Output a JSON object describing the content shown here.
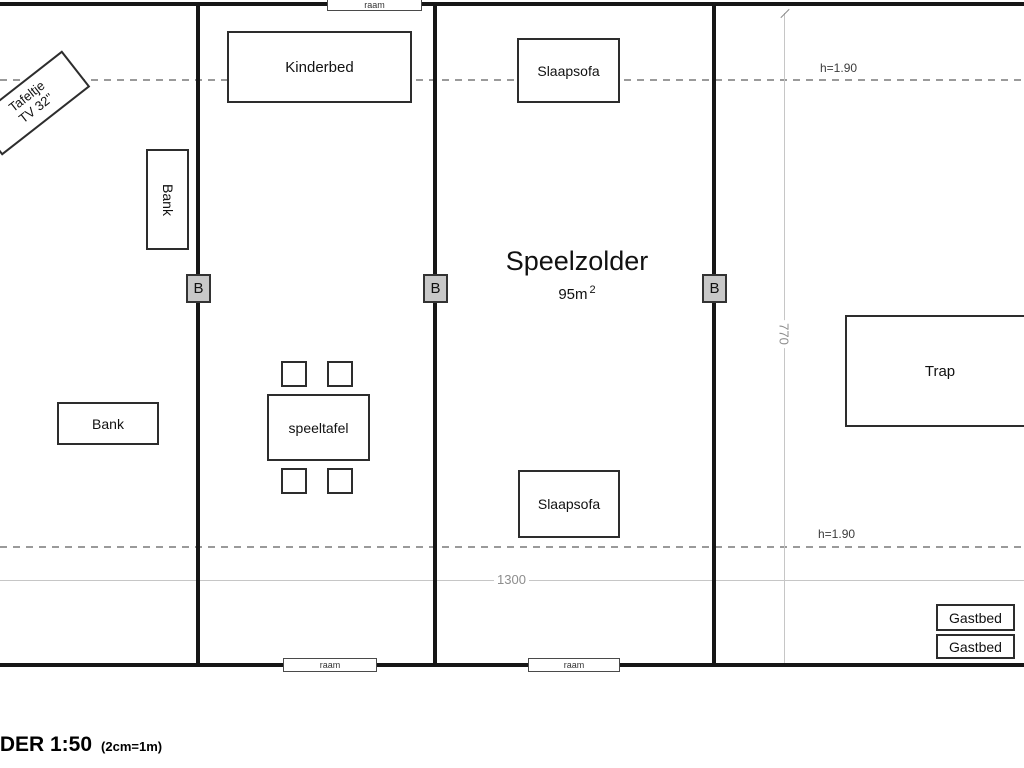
{
  "room": {
    "name": "Speelzolder",
    "area_value": "95m",
    "area_exponent": "2"
  },
  "furniture": {
    "kinderbed": "Kinderbed",
    "slaapsofa_top": "Slaapsofa",
    "slaapsofa_bottom": "Slaapsofa",
    "bank_left_vertical": "Bank",
    "bank_left_horizontal": "Bank",
    "speeltafel": "speeltafel",
    "trap": "Trap",
    "gastbed_top": "Gastbed",
    "gastbed_bottom": "Gastbed",
    "tafeltje_line1": "Tafeltje",
    "tafeltje_line2": "TV 32\""
  },
  "windows": {
    "label": "raam"
  },
  "beam_marker": "B",
  "dimensions": {
    "width": "1300",
    "depth": "770",
    "clearance_top": "h=1.90",
    "clearance_bottom": "h=1.90"
  },
  "title": {
    "scale": "LDER 1:50",
    "note": "(2cm=1m)"
  },
  "colors": {
    "wall": "#161616",
    "dashed_line": "#9a9a9a",
    "dim_line": "#c6c6c6",
    "dim_text": "#8d8d8d",
    "beam_fill": "#c8c8c8",
    "background": "#ffffff"
  }
}
